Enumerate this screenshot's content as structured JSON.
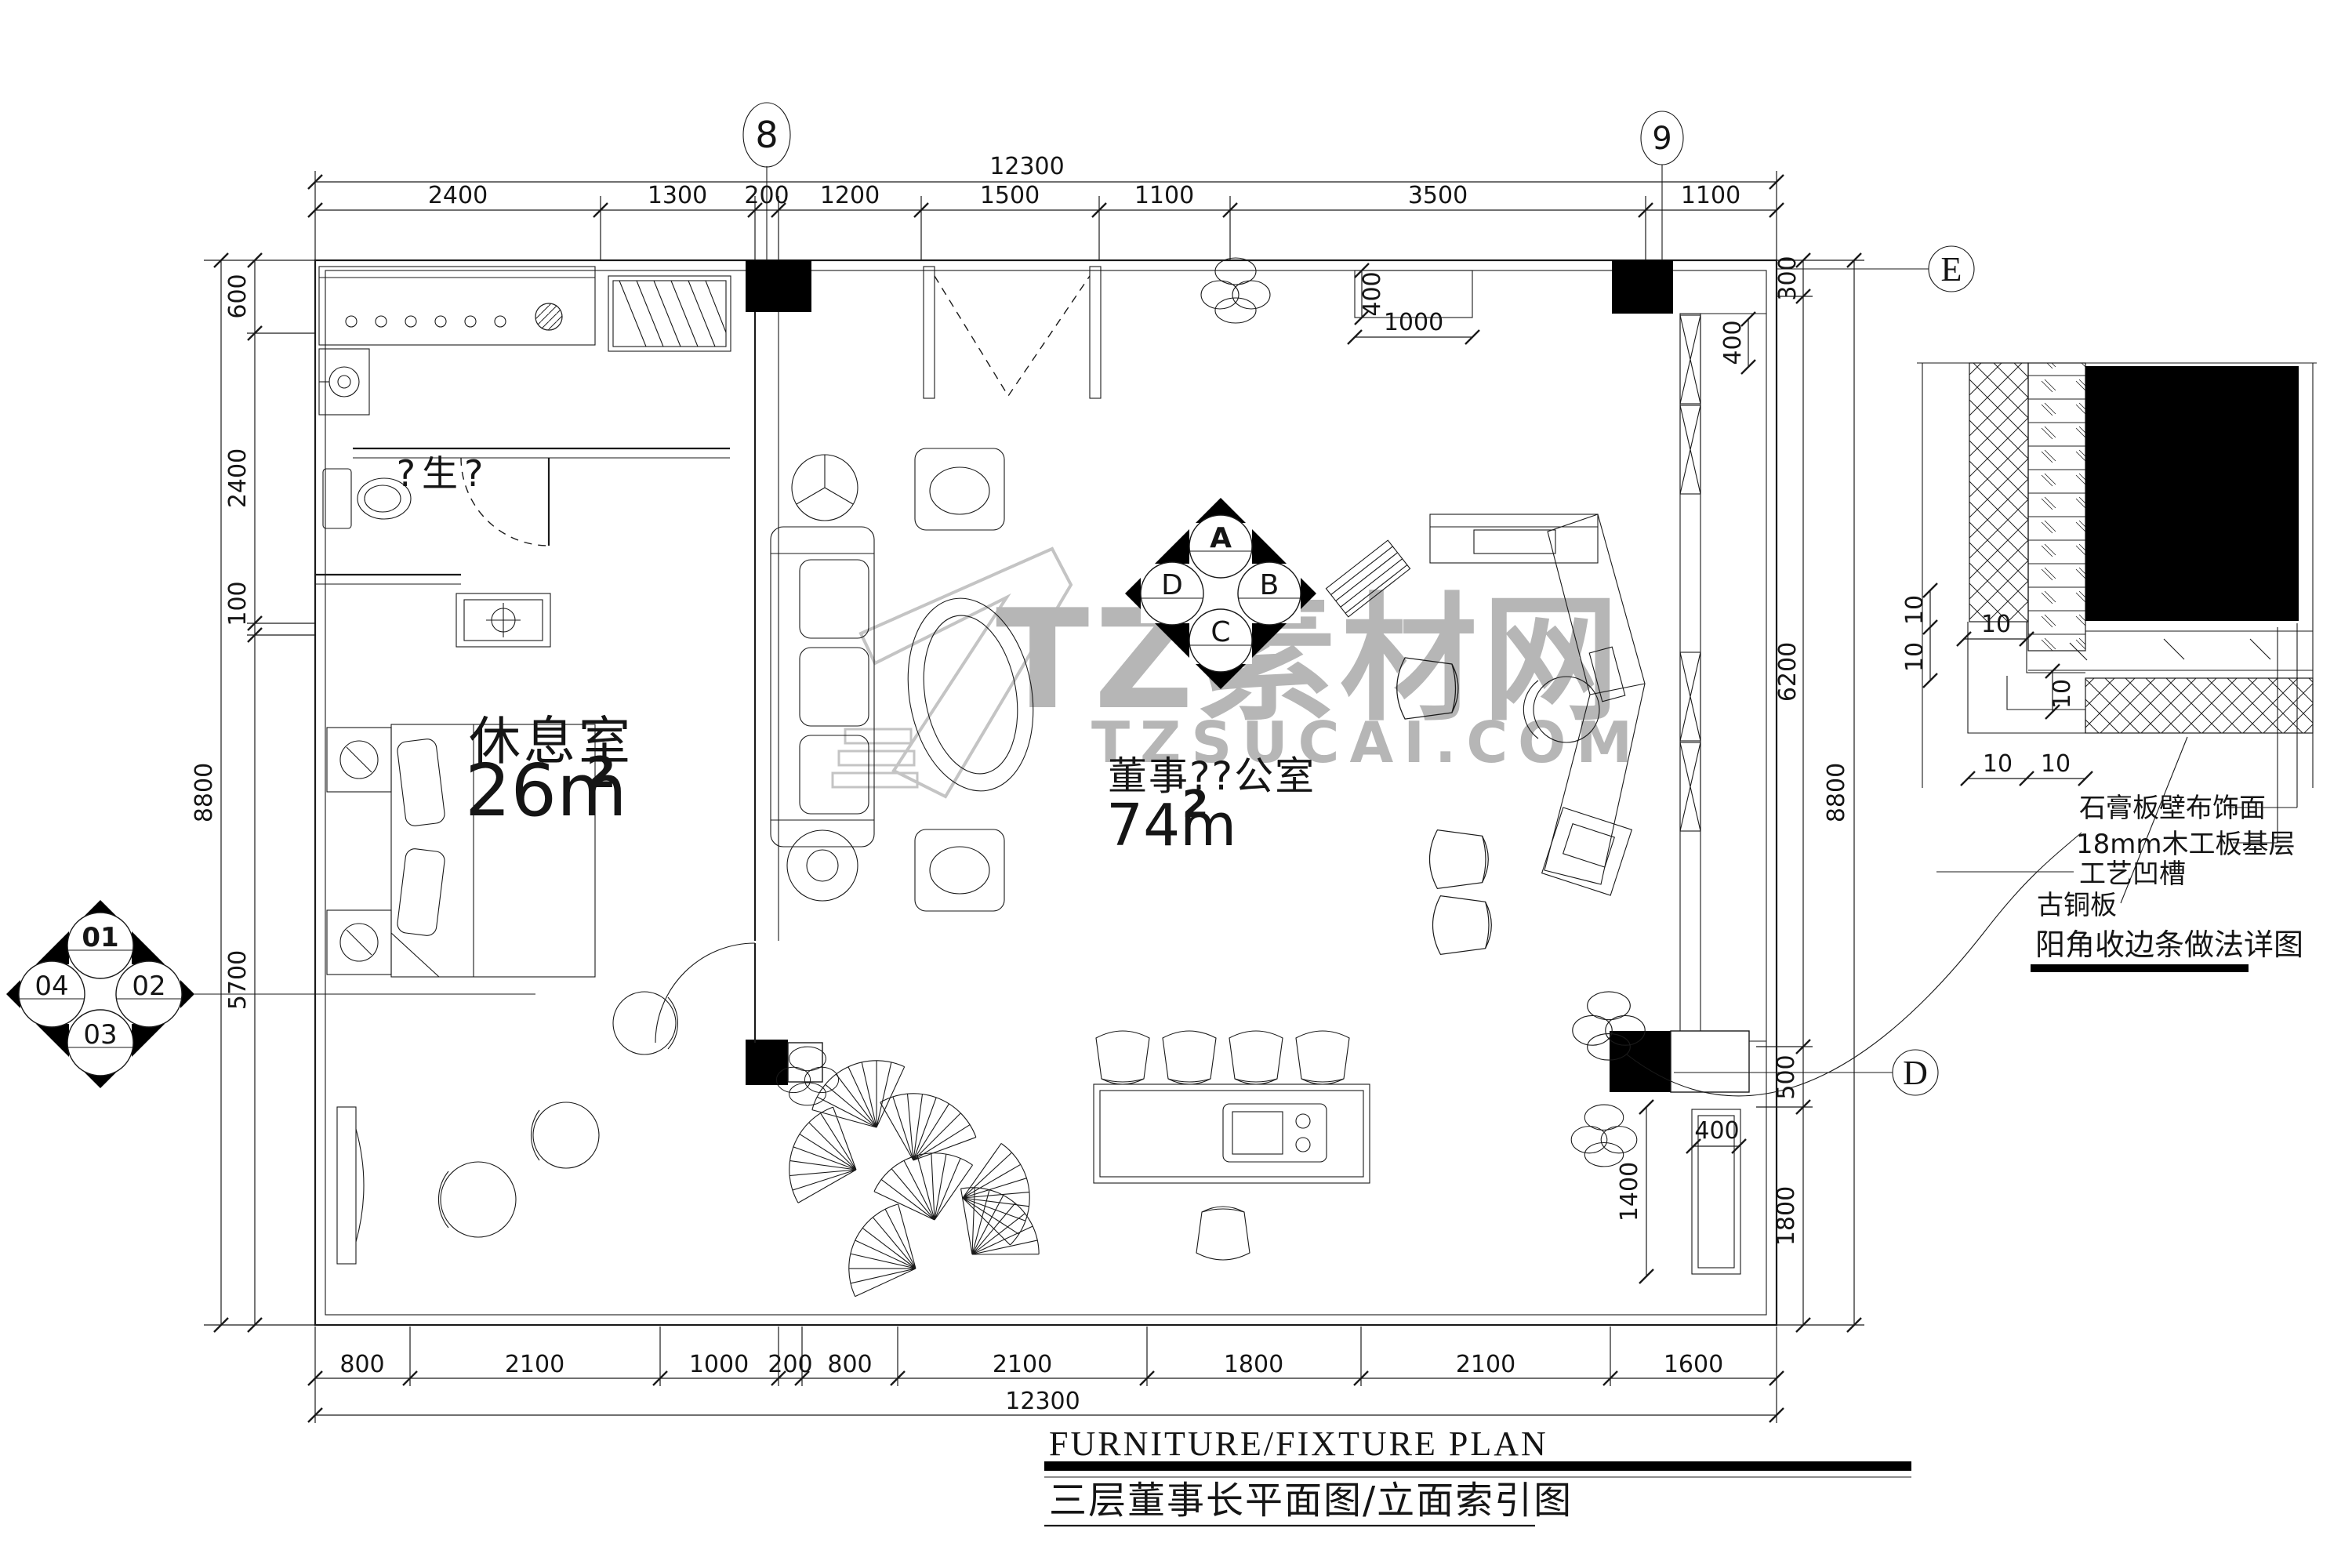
{
  "watermark": {
    "brand": "TZ素材网",
    "site": "TZSUCAI.COM",
    "color": "#b6b6b6"
  },
  "grid": {
    "g8": "8",
    "g9": "9",
    "gE": "E",
    "gD": "D"
  },
  "rooms": {
    "rest": {
      "name": "休息室",
      "area": "26m",
      "sup": "2"
    },
    "office": {
      "name": "董事??公室",
      "area": "74m",
      "sup": "2"
    },
    "bath_label": "?生?"
  },
  "dims": {
    "top_total": "12300",
    "top": [
      "2400",
      "1300",
      "200",
      "1200",
      "1500",
      "1100",
      "3500",
      "1100"
    ],
    "bottom_total": "12300",
    "bottom": [
      "800",
      "2100",
      "1000",
      "200",
      "800",
      "2100",
      "1800",
      "2100",
      "1600"
    ],
    "left_total": "8800",
    "left": [
      "600",
      "2400",
      "100",
      "5700"
    ],
    "right_total": "8800",
    "right": [
      "300",
      "6200",
      "500",
      "1800"
    ],
    "inner": {
      "top_cab_h": "400",
      "top_cab_w": "1000",
      "right_wall": "400",
      "right_cab": "400",
      "right_depth": "1400"
    },
    "detail": [
      "10",
      "10",
      "10",
      "10",
      "10",
      "10"
    ]
  },
  "index_plan": {
    "top": "A",
    "right": "B",
    "bottom": "C",
    "left": "D"
  },
  "index_left": {
    "top": "01",
    "right": "02",
    "bottom": "03",
    "left": "04"
  },
  "detail_callout": {
    "labels": [
      "石膏板壁布饰面",
      "18mm木工板基层",
      "工艺凹槽",
      "古铜板"
    ],
    "title": "阳角收边条做法详图"
  },
  "titleblock": {
    "en": "FURNITURE/FIXTURE PLAN",
    "zh": "三层董事长平面图/立面索引图"
  }
}
